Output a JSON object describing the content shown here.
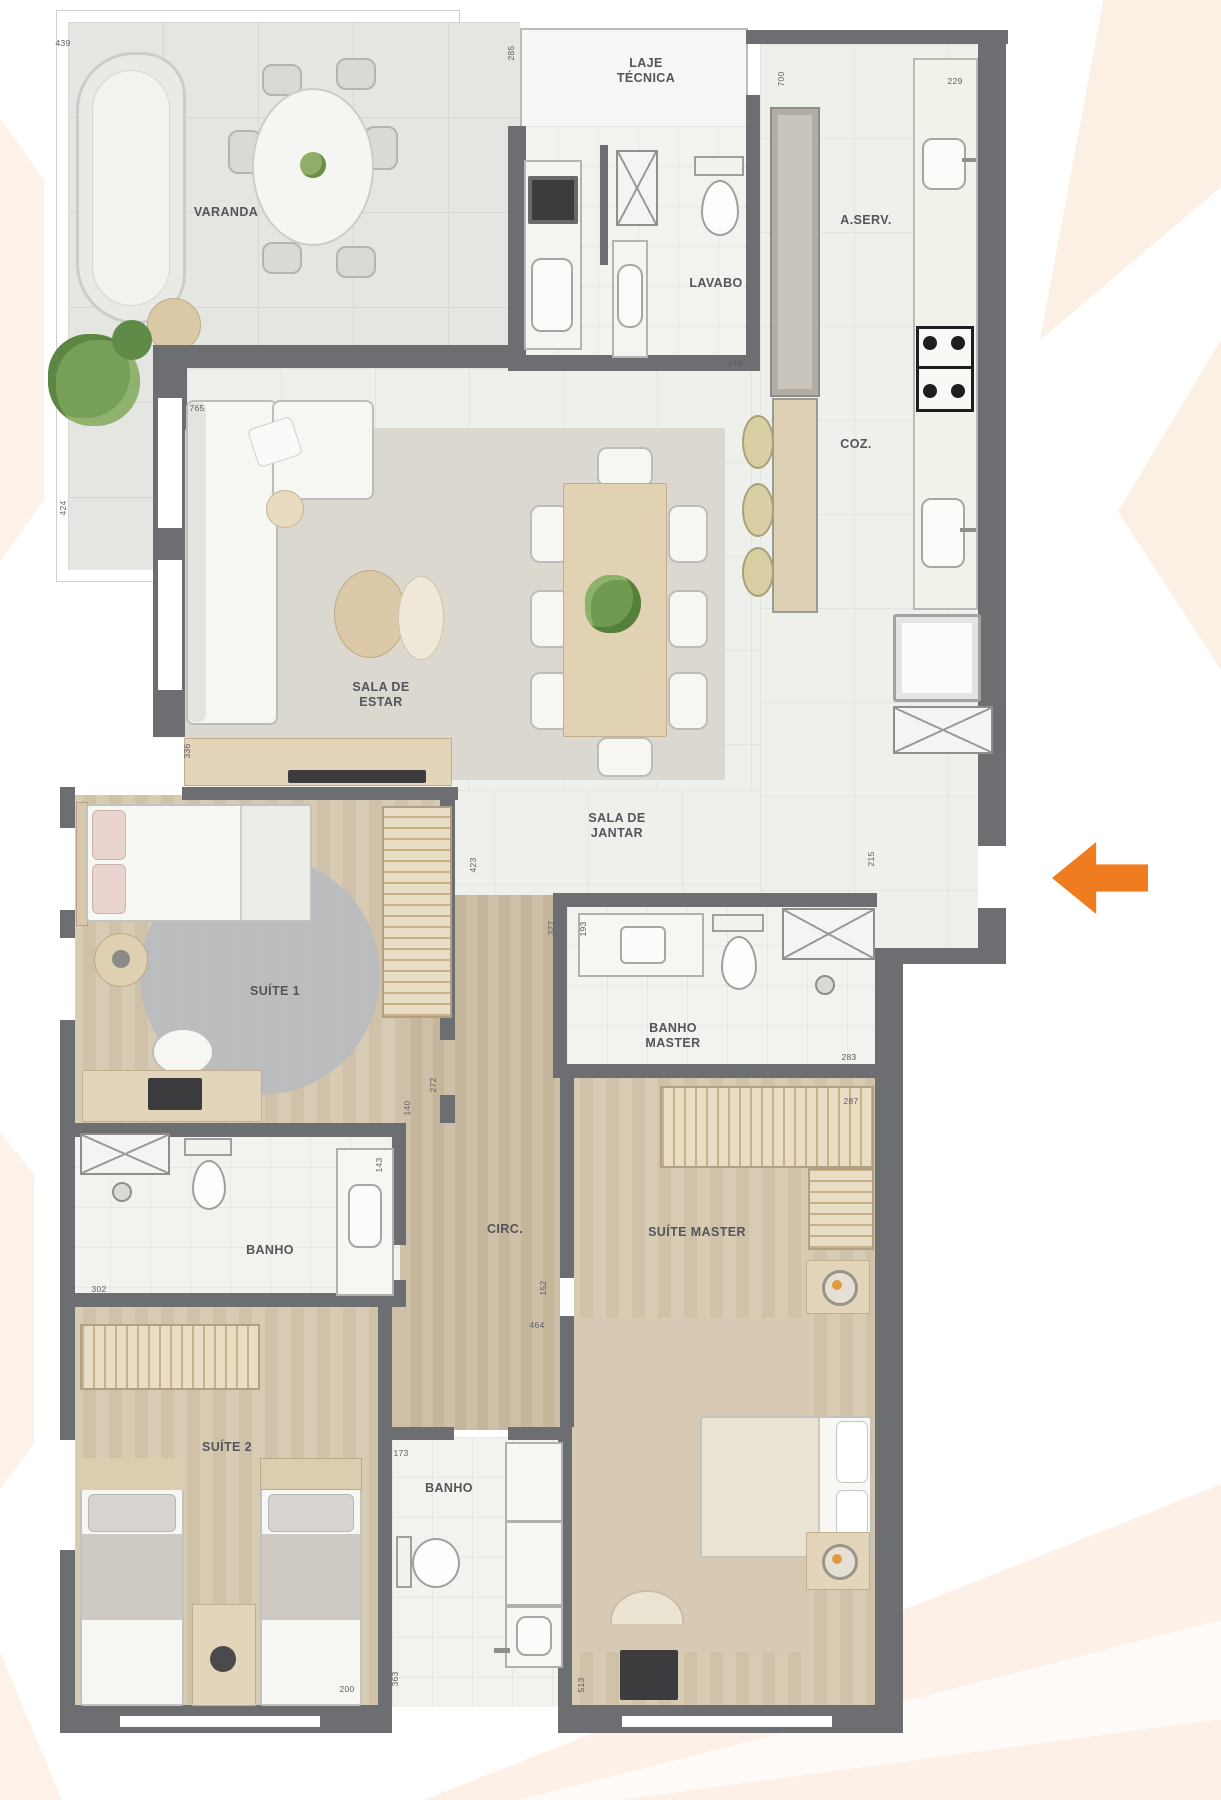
{
  "plan": {
    "rooms": {
      "varanda": {
        "label": "VARANDA"
      },
      "laje_tecnica": {
        "label": "LAJE TÉCNICA"
      },
      "a_serv": {
        "label": "A.SERV."
      },
      "lavabo": {
        "label": "LAVABO"
      },
      "coz": {
        "label": "COZ."
      },
      "sala_estar": {
        "label": "SALA DE ESTAR"
      },
      "sala_jantar": {
        "label": "SALA DE JANTAR"
      },
      "suite1": {
        "label": "SUÍTE 1"
      },
      "banho_master": {
        "label": "BANHO MASTER"
      },
      "banho1": {
        "label": "BANHO"
      },
      "circ": {
        "label": "CIRC."
      },
      "suite_master": {
        "label": "SUÍTE MASTER"
      },
      "suite2": {
        "label": "SUÍTE 2"
      },
      "banho2": {
        "label": "BANHO"
      }
    },
    "dims": {
      "d439": "439",
      "d424": "424",
      "d285": "285",
      "d700": "700",
      "d229": "229",
      "d146": "146",
      "d765": "765",
      "d336": "336",
      "d423": "423",
      "d327": "327",
      "d193": "193",
      "d283": "283",
      "d287": "287",
      "d272": "272",
      "d140": "140",
      "d143": "143",
      "d302": "302",
      "d152": "152",
      "d464": "464",
      "d173": "173",
      "d200": "200",
      "d363": "363",
      "d513": "513",
      "d215": "215"
    },
    "entry_arrow": {
      "color": "#EF7D1F"
    },
    "colors": {
      "wall": "#6D6E72",
      "decor_peach": "#FCEFE5",
      "wood_floor": "#D3C5AE",
      "tile_floor": "#EEF0EC"
    }
  }
}
